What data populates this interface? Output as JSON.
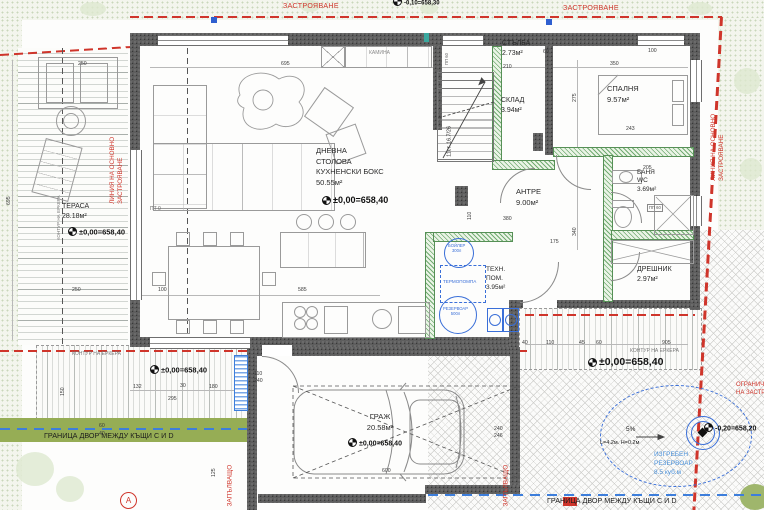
{
  "plan": {
    "rooms": {
      "terrace": {
        "label": "ТЕРАСА\n28.18м²"
      },
      "living": {
        "label": "ДНЕВНА\nСТОЛОВА\nКУХНЕНСКИ БОКС\n50.55м²"
      },
      "stairs": {
        "label": "СТЪЛБА\n2.73м²"
      },
      "sklad": {
        "label": "СКЛАД\n3.94м²"
      },
      "bedroom": {
        "label": "СПАЛНЯ\n9.57м²"
      },
      "antre": {
        "label": "АНТРЕ\n9.00м²"
      },
      "bath": {
        "label": "БАНЯ\nWC\n3.69м²"
      },
      "dreshnik": {
        "label": "ДРЕШНИК\n2.97м²"
      },
      "tehn": {
        "label": "ТЕХН.\nПОМ.\n3.95м²"
      },
      "garage": {
        "label": "ГРАЖ\n20.58м²"
      }
    },
    "levels": {
      "terrace": "±0,00=658,40",
      "living": "±0,00=658,40",
      "porch_left": "±0,00=658,40",
      "porch_right": "±0,00=658,40",
      "garage": "±0,00=658,40",
      "yard": "-0,20=658,20",
      "top_edge": "-0,10=658,30"
    },
    "red": {
      "zastroyavane": "ЗАСТРОЯВАНЕ",
      "osnovno_line": "ЛИНИЯ НА ОСНОВНО\nЗАСТРОЯВАНЕ",
      "ogranichenie": "ОГРАНИЧ.\nНА ЗАСТР.",
      "zapalvashto": "ЗАПЪЛВАЩО"
    },
    "blue": {
      "heat_pump": "ТЕРМОПОМПА",
      "boiler": "БОЙЛЕР\n300л",
      "tank": "РЕЗЕРВОАР\n500л",
      "septic": "ИЗГРЕБЕН\nРЕЗЕРВОАР\n8.5 куб.м"
    },
    "boundary": {
      "left": "ГРАНИЦА ДВОР МЕЖДУ КЪЩИ С И D",
      "right": "ГРАНИЦА ДВОР МЕЖДУ КЪЩИ С И D"
    },
    "notes": {
      "kamina": "КАМИНА",
      "kontur_erkera": "КОНТУР НА ЕРКЕРА",
      "stairs_note": "11ст. 16.7/26",
      "pp60": "ПП 60",
      "pt0": "ПТ 0",
      "axis": "А",
      "ramp_slope": "5%",
      "ramp_size": "L=4.2м. H=0.2м"
    },
    "dims": [
      {
        "t": "250",
        "x": 78,
        "y": 61
      },
      {
        "t": "695",
        "x": 281,
        "y": 61
      },
      {
        "t": "210",
        "x": 503,
        "y": 64
      },
      {
        "t": "60",
        "x": 543,
        "y": 49
      },
      {
        "t": "100",
        "x": 648,
        "y": 48
      },
      {
        "t": "350",
        "x": 610,
        "y": 61
      },
      {
        "t": "275",
        "x": 572,
        "y": 102,
        "v": 1
      },
      {
        "t": "243",
        "x": 626,
        "y": 126
      },
      {
        "t": "205",
        "x": 643,
        "y": 165
      },
      {
        "t": "380",
        "x": 503,
        "y": 216
      },
      {
        "t": "340",
        "x": 572,
        "y": 236,
        "v": 1
      },
      {
        "t": "175",
        "x": 550,
        "y": 239
      },
      {
        "t": "110",
        "x": 467,
        "y": 220,
        "v": 1
      },
      {
        "t": "250",
        "x": 72,
        "y": 287
      },
      {
        "t": "100",
        "x": 158,
        "y": 287
      },
      {
        "t": "585",
        "x": 298,
        "y": 287
      },
      {
        "t": "695",
        "x": 6,
        "y": 205,
        "v": 1
      },
      {
        "t": "132",
        "x": 133,
        "y": 384
      },
      {
        "t": "30",
        "x": 180,
        "y": 383
      },
      {
        "t": "180",
        "x": 209,
        "y": 384
      },
      {
        "t": "295",
        "x": 168,
        "y": 396
      },
      {
        "t": "110",
        "x": 254,
        "y": 371
      },
      {
        "t": "240",
        "x": 254,
        "y": 378
      },
      {
        "t": "40",
        "x": 522,
        "y": 340
      },
      {
        "t": "110",
        "x": 546,
        "y": 340
      },
      {
        "t": "45",
        "x": 579,
        "y": 340
      },
      {
        "t": "60",
        "x": 596,
        "y": 340
      },
      {
        "t": "905",
        "x": 662,
        "y": 340
      },
      {
        "t": "600",
        "x": 382,
        "y": 468
      },
      {
        "t": "240",
        "x": 494,
        "y": 426
      },
      {
        "t": "246",
        "x": 494,
        "y": 433
      },
      {
        "t": "125",
        "x": 211,
        "y": 477,
        "v": 1
      },
      {
        "t": "150",
        "x": 60,
        "y": 396,
        "v": 1
      },
      {
        "t": "60",
        "x": 99,
        "y": 423
      },
      {
        "t": "40",
        "x": 99,
        "y": 431
      }
    ]
  }
}
